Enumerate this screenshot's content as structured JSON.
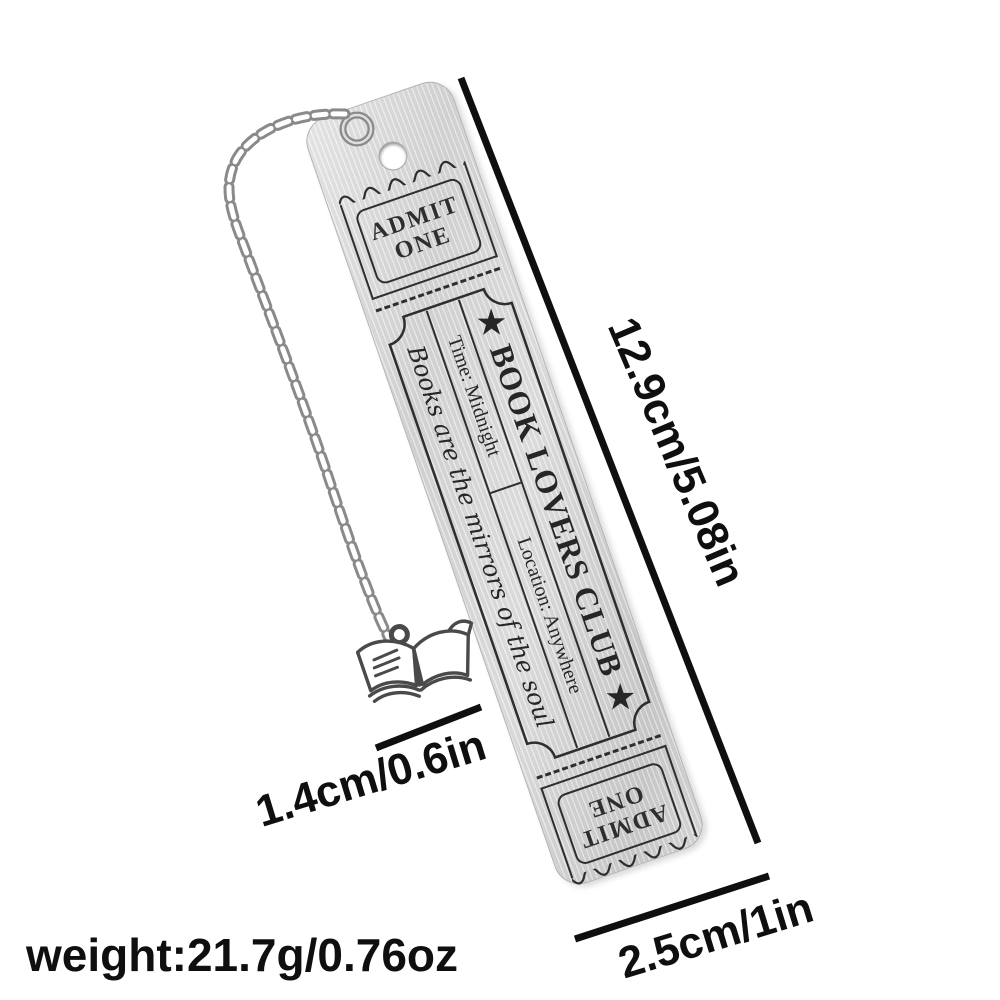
{
  "bookmark": {
    "top_ticket": {
      "line1": "ADMIT",
      "line2": "ONE"
    },
    "main_ticket": {
      "title": "★ BOOK LOVERS CLUB ★",
      "time": "Time: Midnight",
      "location": "Location: Anywhere",
      "quote": "Books are the mirrors of the soul"
    },
    "bottom_ticket": {
      "line1": "ADMIT",
      "line2": "ONE"
    }
  },
  "annotations": {
    "length": "12.9cm/5.08in",
    "charm_width": "1.4cm/0.6in",
    "plate_width": "2.5cm/1in",
    "weight": "weight:21.7g/0.76oz"
  },
  "icons": {
    "chain": "curb-link-chain",
    "book_charm": "open-book",
    "jump_ring": "metal-ring"
  },
  "colors": {
    "background": "#ffffff",
    "annotation_text": "#0f0f0f",
    "engraving": "#2e2e2e",
    "metal_light": "#e9e9e9",
    "metal_dark": "#c7c7c7"
  }
}
